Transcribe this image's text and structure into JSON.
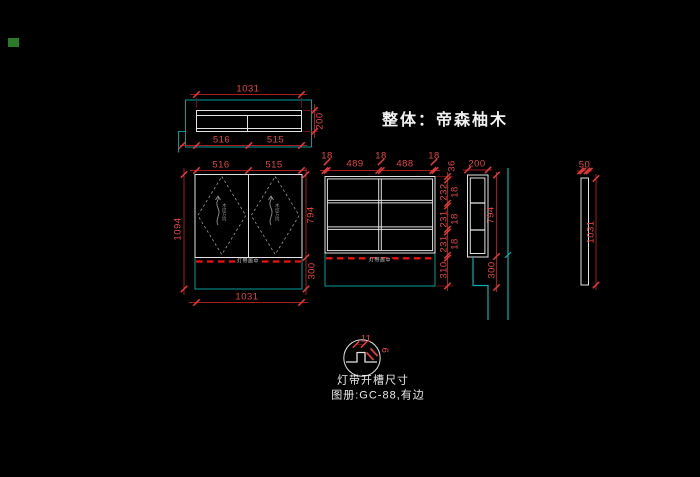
{
  "title": {
    "text": "整体：帝森柚木"
  },
  "marker": {
    "color": "#2a7a2a"
  },
  "views": {
    "top": {
      "dims": {
        "width": "1031",
        "depth": "200",
        "left": "516",
        "right": "515"
      }
    },
    "front": {
      "dims": {
        "door_left": "516",
        "door_right": "515",
        "height": "1094",
        "body": "794",
        "bottom": "300",
        "width": "1031"
      },
      "door_label": "木纹方向",
      "strip_label": "灯带居中"
    },
    "carcass": {
      "top_dims": [
        "18",
        "489",
        "18",
        "488",
        "18"
      ],
      "side_dims": {
        "top": "36",
        "r1": "232",
        "t1": "18",
        "r2": "231",
        "t2": "18",
        "r3": "231",
        "t3": "18",
        "bottom": "310"
      },
      "strip_label": "灯带居中"
    },
    "section": {
      "dims": {
        "depth": "200",
        "body": "794",
        "bottom": "300"
      }
    },
    "panel": {
      "dims": {
        "thickness": "50",
        "length": "1031"
      }
    },
    "detail": {
      "dims": {
        "notch_width": "11",
        "notch_depth": "9"
      },
      "caption": "灯带开槽尺寸",
      "note": "图册:GC-88,有边"
    }
  }
}
